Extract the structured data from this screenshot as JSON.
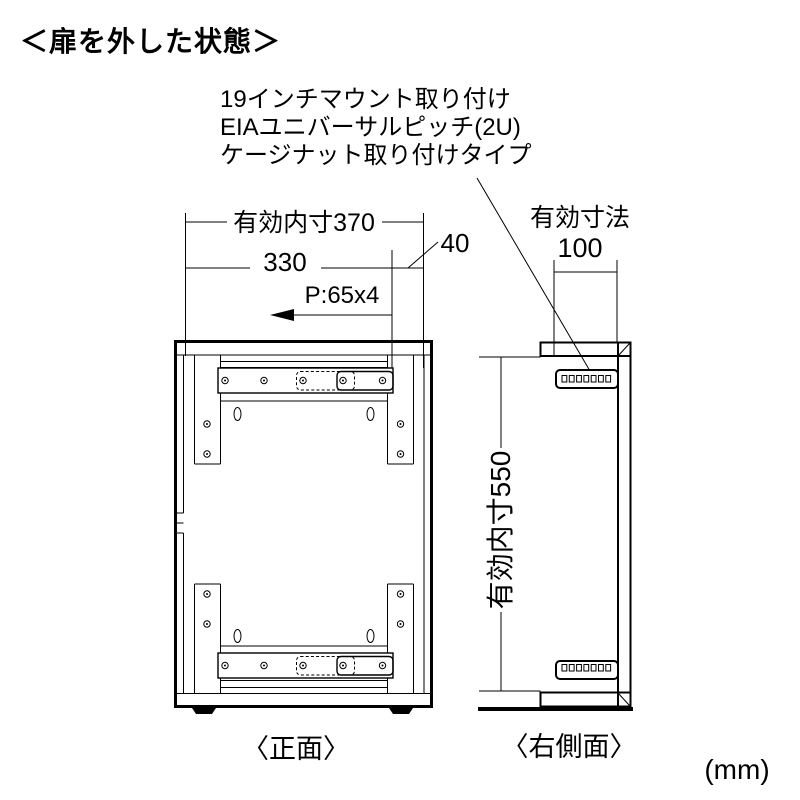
{
  "title": "＜扉を外した状態＞",
  "unit": "(mm)",
  "annotation": {
    "line1": "19インチマウント取り付け",
    "line2": "EIAユニバーサルピッチ(2U)",
    "line3": "ケージナット取り付けタイプ"
  },
  "front_view": {
    "label": "〈正面〉",
    "dim_inner_width": "有効内寸370",
    "dim_mount_width": "330",
    "dim_offset": "40",
    "dim_pitch": "P:65x4"
  },
  "side_view": {
    "label": "〈右側面〉",
    "dim_depth_label": "有効寸法",
    "dim_depth_value": "100",
    "dim_inner_height": "有効内寸550"
  },
  "colors": {
    "line": "#000000",
    "background": "#ffffff"
  }
}
